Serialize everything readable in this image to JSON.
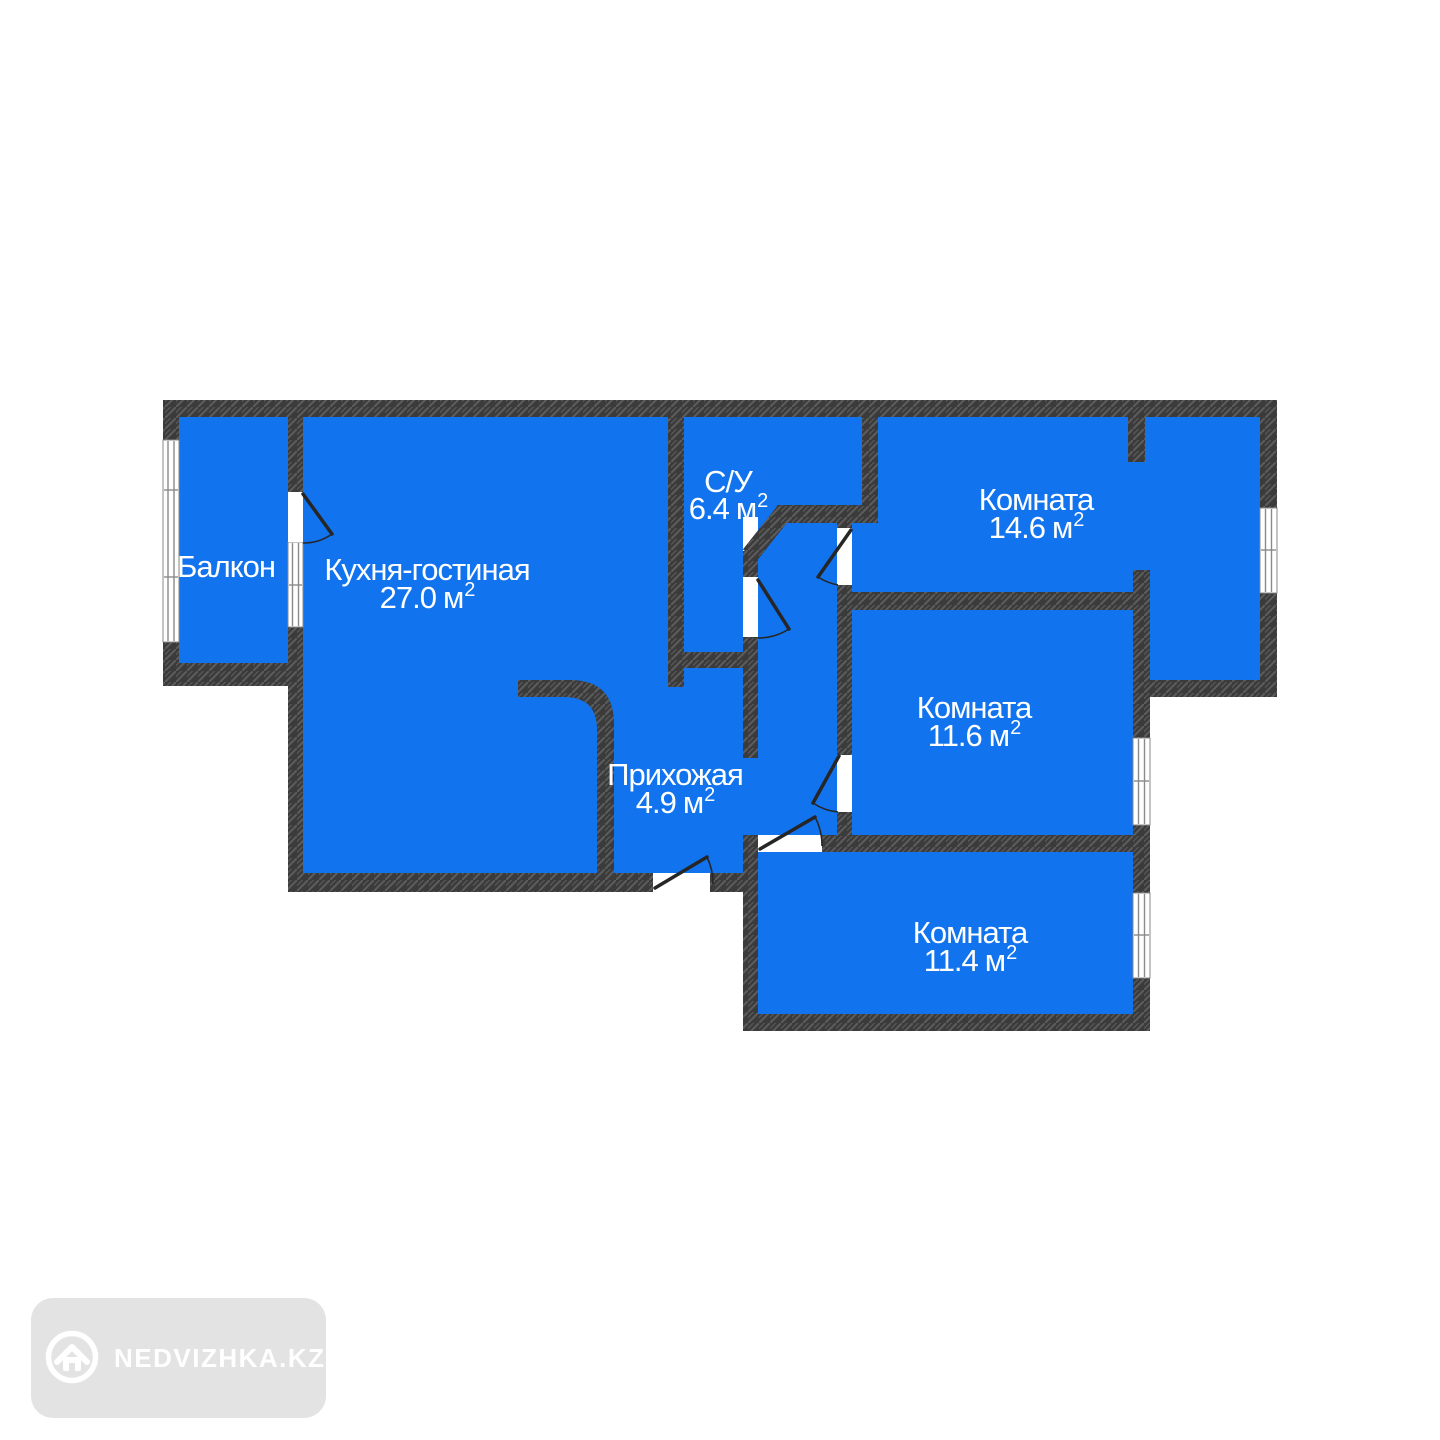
{
  "colors": {
    "background": "#ffffff",
    "room_fill": "#1173ee",
    "wall": "#3b3b3b",
    "wall_hatch": "#5d5d5d",
    "label_text": "#ffffff",
    "window_frame": "#8a8a8a",
    "door_line": "#262626",
    "watermark_bg": "#e3e3e3",
    "watermark_fg": "#ffffff"
  },
  "plan": {
    "type": "apartment-floor-plan",
    "rooms": [
      {
        "id": "balcony",
        "name": "Балкон"
      },
      {
        "id": "kitchen-living",
        "name": "Кухня-гостиная",
        "area_value": "27.0",
        "area_unit": "м",
        "area_sup": "2"
      },
      {
        "id": "bathroom",
        "name": "С/У",
        "area_value": "6.4",
        "area_unit": "м",
        "area_sup": "2"
      },
      {
        "id": "room-1",
        "name": "Комната",
        "area_value": "14.6",
        "area_unit": "м",
        "area_sup": "2"
      },
      {
        "id": "room-2",
        "name": "Комната",
        "area_value": "11.6",
        "area_unit": "м",
        "area_sup": "2"
      },
      {
        "id": "room-3",
        "name": "Комната",
        "area_value": "11.4",
        "area_unit": "м",
        "area_sup": "2"
      },
      {
        "id": "hallway",
        "name": "Прихожая",
        "area_value": "4.9",
        "area_unit": "м",
        "area_sup": "2"
      }
    ]
  },
  "watermark": {
    "brand": "NEDVIZHKA.KZ",
    "icon": "house-icon"
  }
}
